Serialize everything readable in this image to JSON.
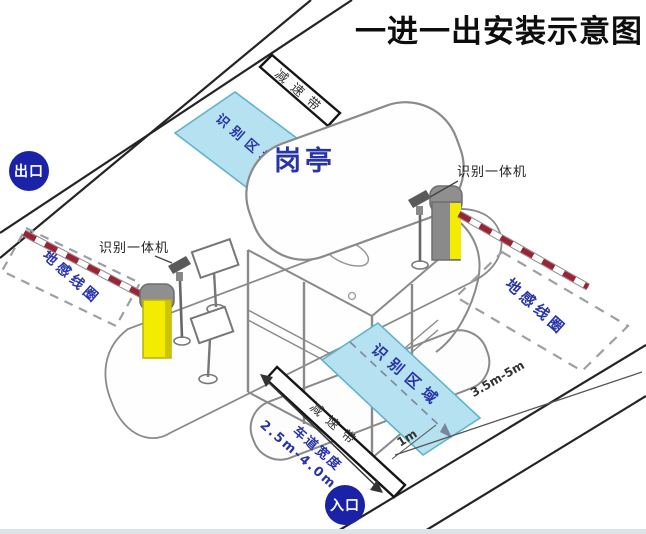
{
  "title": "一进一出安装示意图",
  "badges": {
    "exit": "出口",
    "entrance": "入口"
  },
  "booth": {
    "label": "岗亭"
  },
  "labels": {
    "recognition_machine_left": "识别一体机",
    "recognition_machine_right": "识别一体机",
    "recognition_area_top": "识别区域",
    "recognition_area_bottom": "识别区域",
    "ground_coil_left": "地感线圈",
    "ground_coil_right": "地感线圈",
    "speed_bump_top": "减速带",
    "speed_bump_bottom": "减速带"
  },
  "dimensions": {
    "coil_distance": "3.5m-5m",
    "area_offset": "1m",
    "lane_width_label": "车道宽度",
    "lane_width_value": "2.5m-4.0m"
  },
  "colors": {
    "badge_blue": "#1a23a8",
    "label_blue": "#2733a8",
    "area_fill": "#b6e1f0",
    "area_stroke": "#5fb4cc",
    "barrier_yellow": "#f4ec00",
    "barrier_gray": "#8f8f8f",
    "arm_red": "#9b2335",
    "line_black": "#1f1f1f"
  }
}
